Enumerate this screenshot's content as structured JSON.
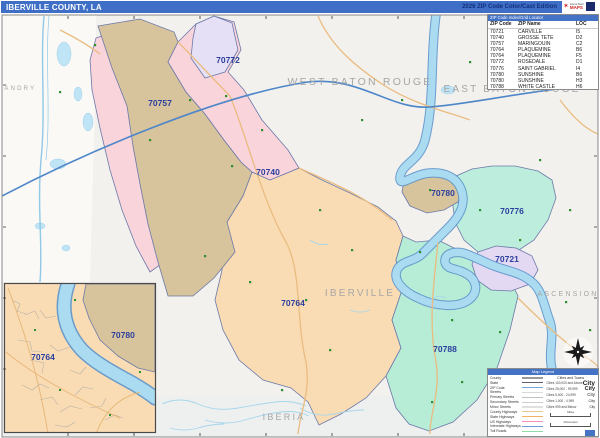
{
  "title_bar": {
    "title": "IBERVILLE COUNTY, LA",
    "edition": "2026 ZIP Code Color/Cast Edition",
    "logo": {
      "brand_top": "HomeTown",
      "brand_main": "MAPS"
    }
  },
  "zip_table": {
    "header": "ZIP Code Index/Grid Locator",
    "columns": [
      "ZIP Code",
      "ZIP Name",
      "LOC"
    ],
    "rows": [
      [
        "70721",
        "CARVILLE",
        "I5"
      ],
      [
        "70740",
        "GROSSE TETE",
        "D2"
      ],
      [
        "70757",
        "MARINGOUIN",
        "C2"
      ],
      [
        "70764",
        "PLAQUEMINE",
        "B6"
      ],
      [
        "70764",
        "PLAQUEMINE",
        "F5"
      ],
      [
        "70772",
        "ROSEDALE",
        "D1"
      ],
      [
        "70776",
        "SAINT GABRIEL",
        "I4"
      ],
      [
        "70780",
        "SUNSHINE",
        "B6"
      ],
      [
        "70780",
        "SUNSHINE",
        "H3"
      ],
      [
        "70788",
        "WHITE CASTLE",
        "H6"
      ]
    ]
  },
  "map": {
    "county_label": "IBERVILLE",
    "parishes": {
      "west_baton_rouge": "WEST BATON ROUGE",
      "east_baton_rouge": "EAST BATON ROUGE",
      "ascension": "ASCENSION",
      "iberia": "IBERIA",
      "st_landry": "ST. LANDRY"
    },
    "zip_labels": [
      "70772",
      "70757",
      "70740",
      "70780",
      "70776",
      "70721",
      "70764",
      "70788"
    ],
    "inset_zip_labels": [
      "70764",
      "70780"
    ],
    "zone_colors": {
      "70772": "#e6e0f6",
      "70757": "#d7c39c",
      "70740": "#f9d4db",
      "70764": "#f9dcb4",
      "70780": "#d7c39c",
      "70776": "#bdeedd",
      "70721": "#e3d9f3",
      "70788": "#b7ecd6"
    },
    "river_color": "#abdbf0",
    "boundary_color": "#6b79a8"
  },
  "legend": {
    "title": "Map Legend",
    "road_items": [
      "County",
      "State",
      "ZIP Code",
      "Streets",
      "Primary Streets",
      "Secondary Streets",
      "Minor Streets",
      "County Highways",
      "State Highways",
      "US Highways",
      "Interstate Highways",
      "Toll Roads"
    ],
    "line_colors": [
      "#9a9a9a",
      "#606070",
      "#7aa7d9",
      "#d9d9d9",
      "#c0c0c0",
      "#cccccc",
      "#e0e0e0",
      "#e8c98f",
      "#f2b263",
      "#f591b8",
      "#6f9bd6",
      "#8fdca6"
    ],
    "cities_header": "Cities and Towns",
    "city_items": [
      {
        "label": "Cities 100,000 and Above",
        "sample": "City"
      },
      {
        "label": "Cities 25,000 - 99,999",
        "sample": "City"
      },
      {
        "label": "Cities 5,000 - 24,999",
        "sample": "City"
      },
      {
        "label": "Cities 1,000 - 4,999",
        "sample": "City"
      },
      {
        "label": "Cities 999 and Below",
        "sample": "City"
      }
    ],
    "scale": {
      "miles": "Miles",
      "kilometers": "Kilometers"
    }
  }
}
